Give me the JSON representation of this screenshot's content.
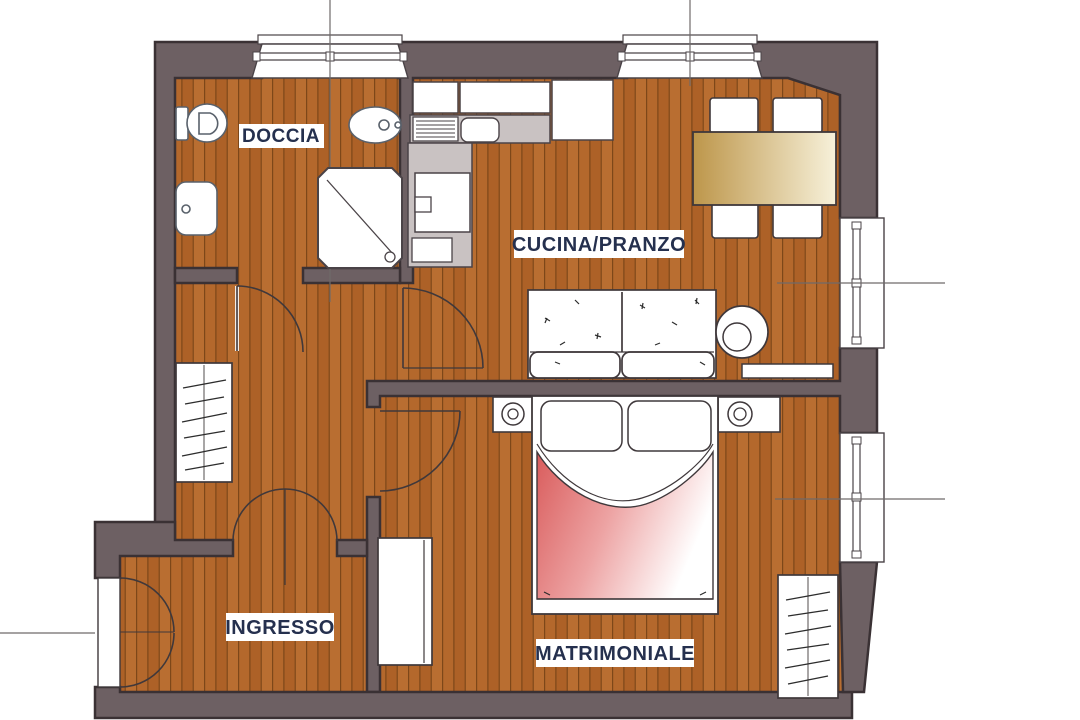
{
  "plan": {
    "type": "apartment-floor-plan",
    "rooms": [
      {
        "id": "doccia",
        "label": "DOCCIA"
      },
      {
        "id": "cucina_pranzo",
        "label": "CUCINA/PRANZO"
      },
      {
        "id": "ingresso",
        "label": "INGRESSO"
      },
      {
        "id": "matrimoniale",
        "label": "MATRIMONIALE"
      }
    ],
    "colors": {
      "wall": "#6d6063",
      "wall_outline": "#3a3134",
      "floor_wood": "#b4682c",
      "floor_plank_line": "#7d4719",
      "counter_gray": "#c9c2c2",
      "table_wood": "#c5a156",
      "bed_blanket_red": "#db5f5f",
      "label_text": "#25304e"
    }
  }
}
